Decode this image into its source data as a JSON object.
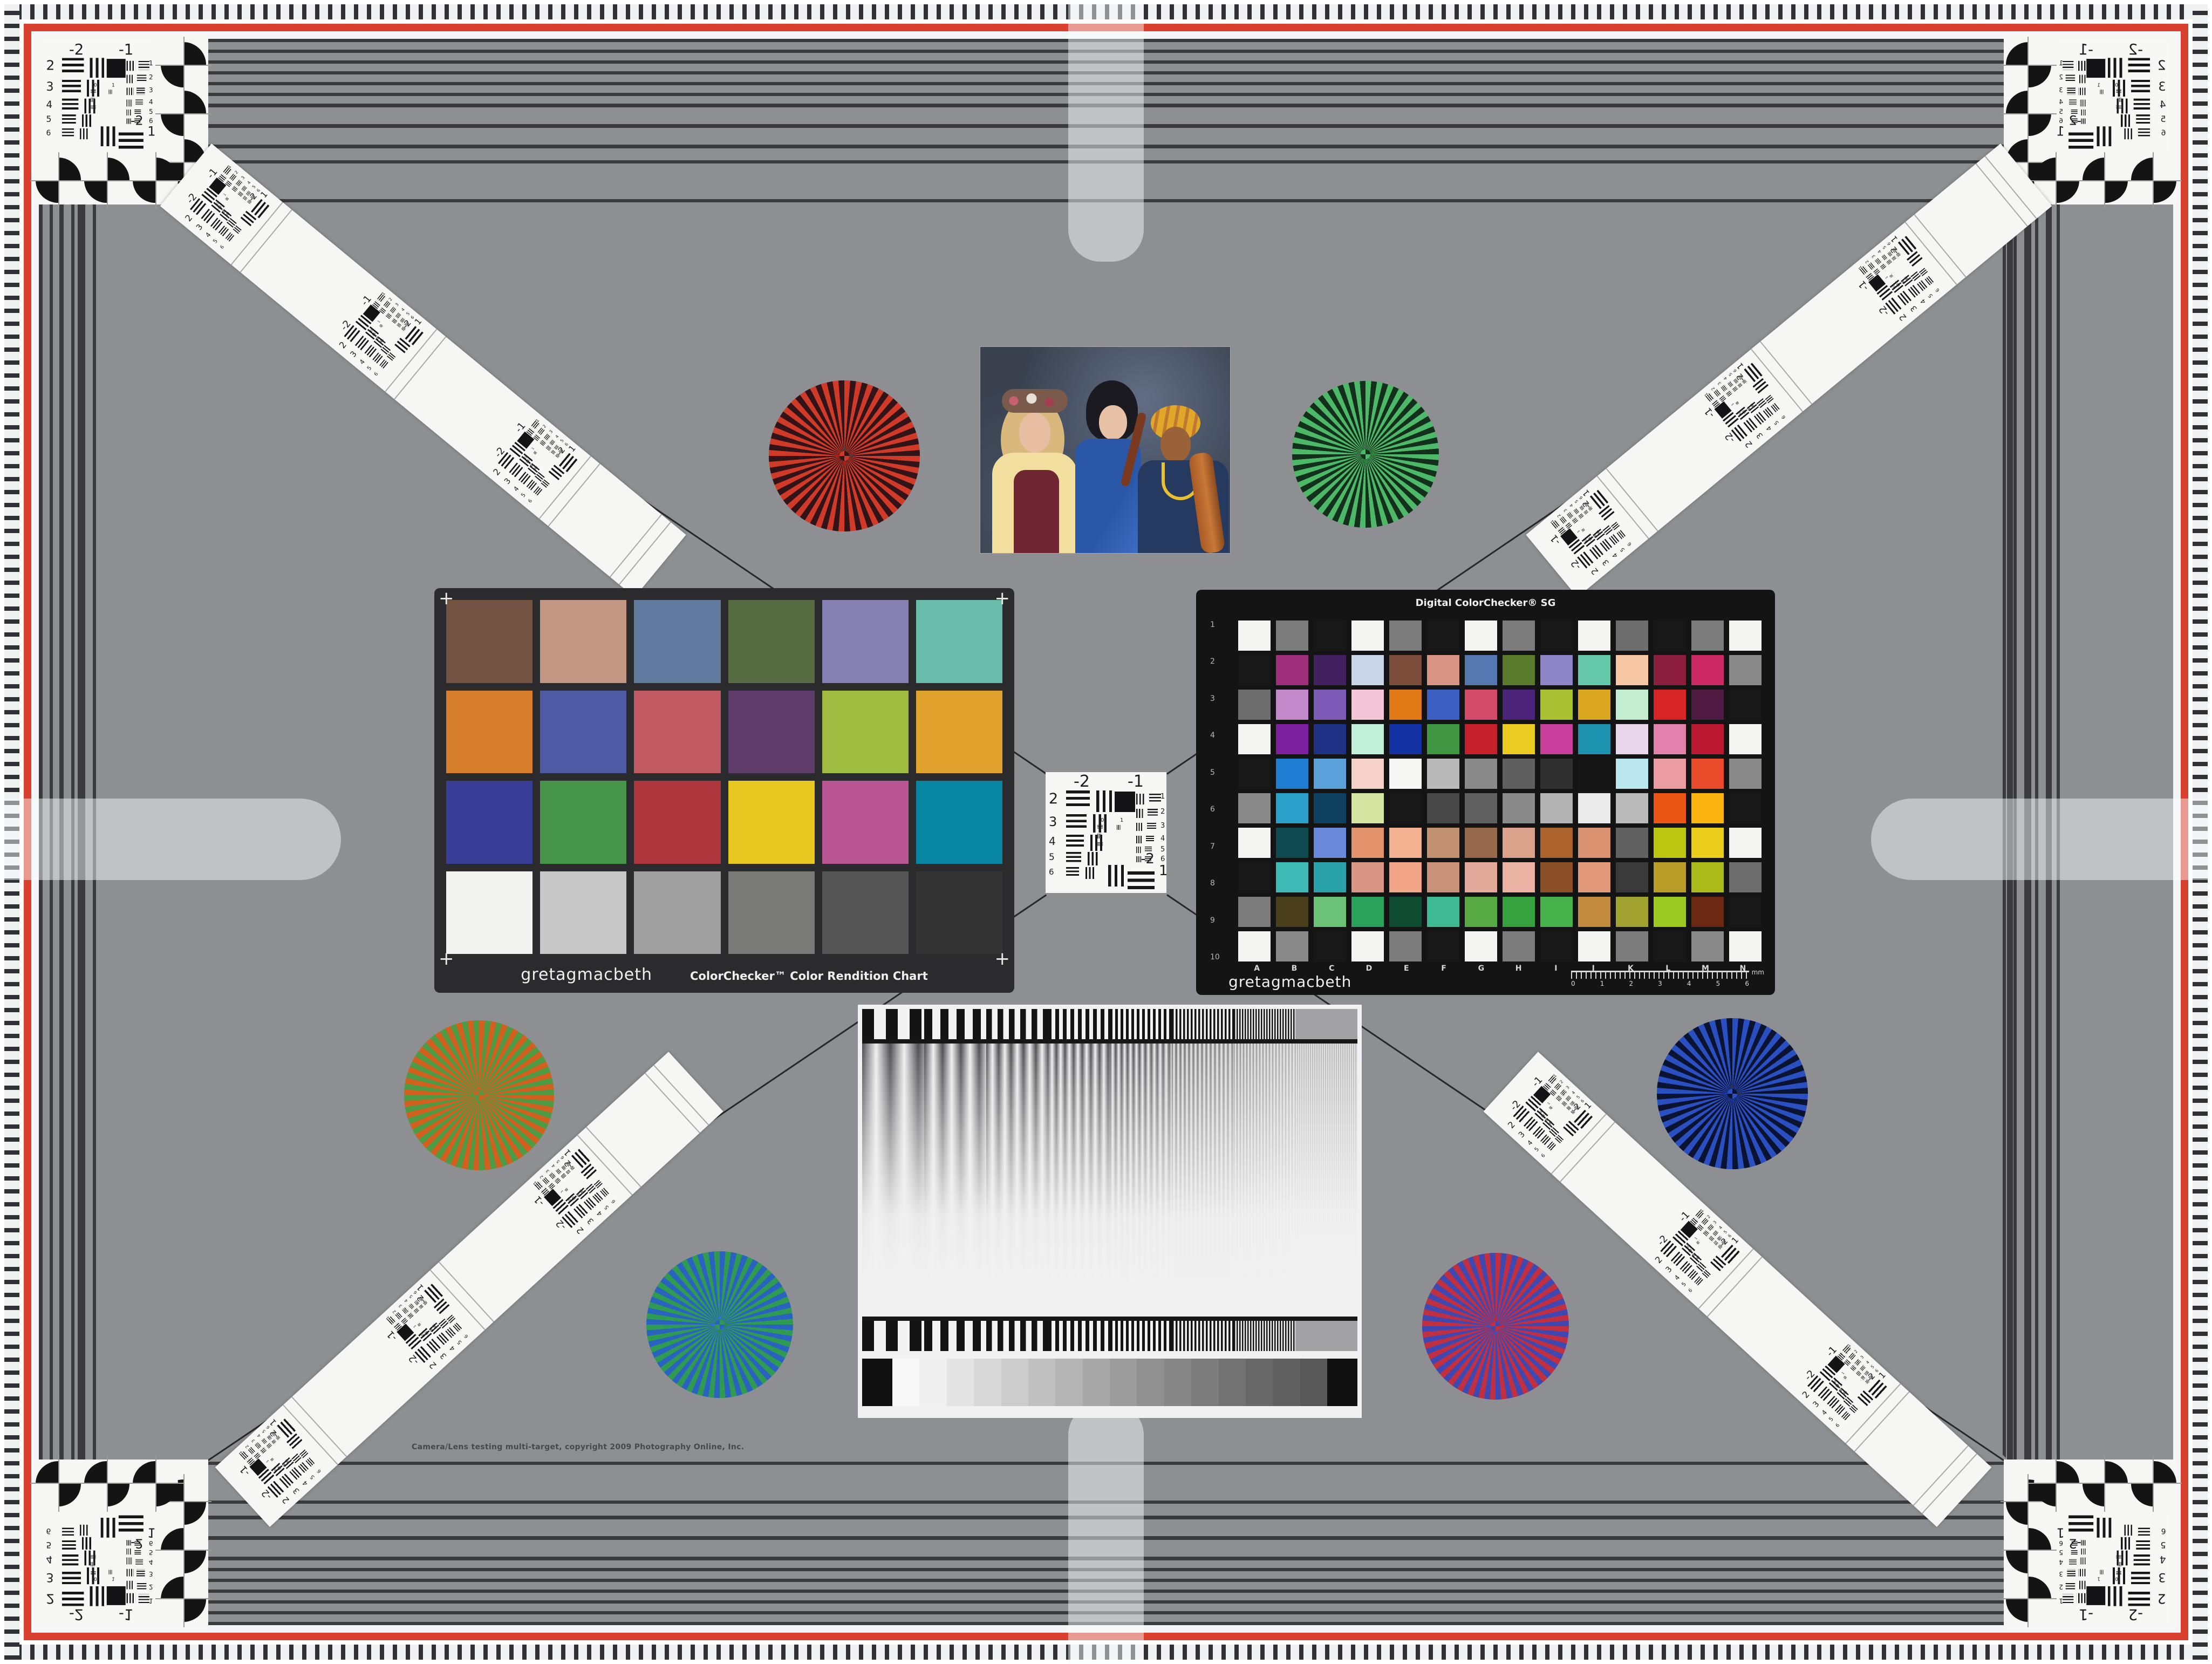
{
  "page": {
    "background": "#8e8f92",
    "copyright": "Camera/Lens testing multi-target, copyright 2009 Photography Online, Inc."
  },
  "border": {
    "red": "#d9402f",
    "white": "#f4f5f7",
    "stripe_dark": "#3a3a3f",
    "bar_tint": "rgba(248,250,252,0.48)"
  },
  "colorchecker": {
    "brand": "gretagmacbeth",
    "title": "ColorChecker™ Color Rendition Chart",
    "corner_mark": "+",
    "rows": [
      [
        "#735244",
        "#c29682",
        "#627a9d",
        "#576c43",
        "#8580b1",
        "#67bdaa"
      ],
      [
        "#d67e2c",
        "#505ba6",
        "#c15a63",
        "#5e3c6c",
        "#9dbc40",
        "#e0a32e"
      ],
      [
        "#383d96",
        "#469449",
        "#af363c",
        "#e7c71f",
        "#bb5695",
        "#0885a1"
      ],
      [
        "#f3f3f2",
        "#c8c8c8",
        "#a0a0a0",
        "#7a7a79",
        "#555555",
        "#343434"
      ]
    ]
  },
  "sg": {
    "title": "Digital ColorChecker® SG",
    "brand": "gretagmacbeth",
    "row_labels": [
      "1",
      "2",
      "3",
      "4",
      "5",
      "6",
      "7",
      "8",
      "9",
      "10"
    ],
    "col_labels": [
      "A",
      "B",
      "C",
      "D",
      "E",
      "F",
      "G",
      "H",
      "I",
      "J",
      "K",
      "L",
      "M",
      "N"
    ],
    "ruler_ticks": [
      "0",
      "1",
      "2",
      "3",
      "4",
      "5",
      "6"
    ],
    "ruler_unit": "mm",
    "rows": [
      [
        "#f4f4f2",
        "#7c7c7c",
        "#181818",
        "#f4f4f2",
        "#7c7c7c",
        "#181818",
        "#f4f4f2",
        "#7c7c7c",
        "#181818",
        "#f4f4f2",
        "#6e6e6e",
        "#181818",
        "#7c7c7c",
        "#f4f4f2"
      ],
      [
        "#181818",
        "#9e2f7c",
        "#41215f",
        "#c9d6e8",
        "#7c4b39",
        "#da9486",
        "#5678b0",
        "#5b7b2c",
        "#8e84c8",
        "#66c8ab",
        "#f6c6a5",
        "#8c1e40",
        "#cb2a63",
        "#8a8a8a"
      ],
      [
        "#6e6e6e",
        "#c489ca",
        "#7d5cb7",
        "#f2c6d6",
        "#e27917",
        "#3c60c2",
        "#d34b69",
        "#4b2479",
        "#aac231",
        "#dba720",
        "#c4ecd1",
        "#d62524",
        "#4e1b43",
        "#181818"
      ],
      [
        "#f4f4f2",
        "#7c20a0",
        "#1f3184",
        "#c1f0d8",
        "#1331a2",
        "#409642",
        "#c6202b",
        "#ebca21",
        "#c93f9c",
        "#1c92af",
        "#ead6ea",
        "#e282aa",
        "#ba1931",
        "#f4f4f2"
      ],
      [
        "#181818",
        "#1f7dd2",
        "#5ca2da",
        "#f6d1ca",
        "#f7f7f5",
        "#b9b9b9",
        "#8a8a8a",
        "#5f5f5f",
        "#303030",
        "#161616",
        "#bae6f0",
        "#ea9ca2",
        "#ea4c2b",
        "#8a8a8a"
      ],
      [
        "#8a8a8a",
        "#2ba0c8",
        "#10405f",
        "#d6e6a2",
        "#181818",
        "#484848",
        "#606060",
        "#8a8a8a",
        "#b2b2b2",
        "#eaeaea",
        "#bababa",
        "#ea5514",
        "#fcb50f",
        "#181818"
      ],
      [
        "#f4f4f2",
        "#0f4a50",
        "#6989da",
        "#e2936b",
        "#f2b291",
        "#c29172",
        "#97694b",
        "#daa28a",
        "#aa632d",
        "#da9271",
        "#616161",
        "#bac60f",
        "#eace19",
        "#f4f4f2"
      ],
      [
        "#181818",
        "#3dbab6",
        "#29a2aa",
        "#da9685",
        "#f2a689",
        "#ca9179",
        "#e2aa9a",
        "#eab2a2",
        "#8b5027",
        "#e29a7a",
        "#3a3a3a",
        "#ba9c29",
        "#aaba19",
        "#6e6e6e"
      ],
      [
        "#7c7c7c",
        "#4b3e1b",
        "#6bc175",
        "#2ba25b",
        "#0e4b31",
        "#3dba91",
        "#57aa43",
        "#35a23d",
        "#47b24b",
        "#c28b3d",
        "#a2a231",
        "#9dca21",
        "#6b2913",
        "#181818"
      ],
      [
        "#f4f4f2",
        "#8a8a8a",
        "#181818",
        "#f4f4f2",
        "#7c7c7c",
        "#181818",
        "#f4f4f2",
        "#7c7c7c",
        "#181818",
        "#f4f4f2",
        "#7c7c7c",
        "#181818",
        "#8a8a8a",
        "#f4f4f2"
      ]
    ]
  },
  "resblock": {
    "top_left": "-2",
    "top_right": "-1",
    "left_rows": [
      "2",
      "3",
      "4",
      "5",
      "6"
    ],
    "right_rows": [
      "1",
      "2",
      "3",
      "4",
      "5",
      "6"
    ],
    "bottom_top": "-2",
    "bottom_right": "1",
    "mini_labels": [
      "0",
      "1"
    ]
  },
  "stars": [
    {
      "name": "red",
      "c1": "#cf3b28",
      "c2": "#321318"
    },
    {
      "name": "green",
      "c1": "#4db868",
      "c2": "#12301b"
    },
    {
      "name": "orange-green",
      "c1": "#d2601e",
      "c2": "#4f9a44"
    },
    {
      "name": "blue",
      "c1": "#2a4fc0",
      "c2": "#0b1332"
    },
    {
      "name": "blue-green",
      "c1": "#2a62c0",
      "c2": "#2f9a52"
    },
    {
      "name": "red-blue",
      "c1": "#c03040",
      "c2": "#3f48b0"
    }
  ],
  "sweep": {
    "wedge_steps": [
      "#f8f8f8",
      "#efefef",
      "#e4e4e4",
      "#d8d8d8",
      "#cccccc",
      "#c0c0c0",
      "#b4b4b4",
      "#a8a8a8",
      "#9c9c9c",
      "#909090",
      "#868686",
      "#7c7c7c",
      "#727272",
      "#686868",
      "#606060",
      "#585858"
    ],
    "wedge_end": "#101010"
  }
}
